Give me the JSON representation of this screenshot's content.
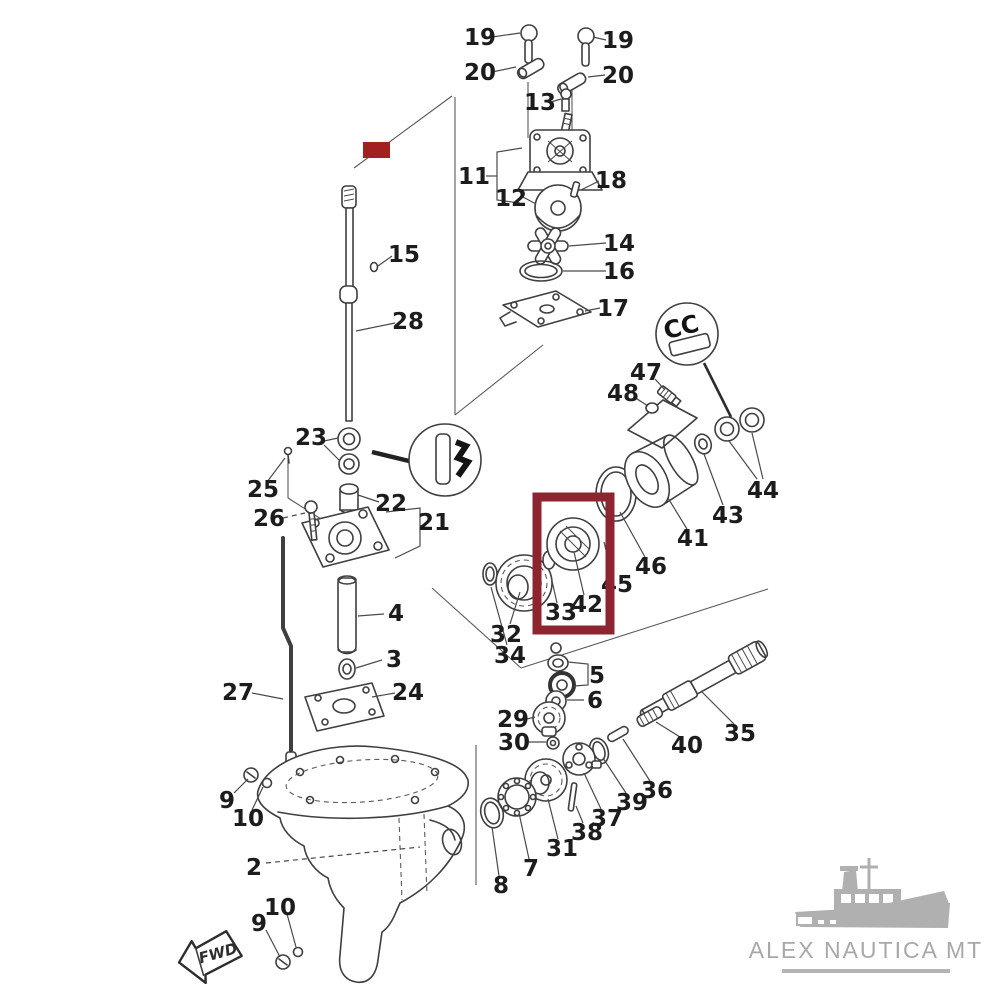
{
  "diagram": {
    "ink_color": "#3f3f3f",
    "label_color": "#1c1c1c",
    "background": "#ffffff"
  },
  "highlights": {
    "box": {
      "x": 537,
      "y": 497,
      "w": 73,
      "h": 133,
      "stroke": "#8e2430",
      "stroke_width": 9
    },
    "mark": {
      "x": 363,
      "y": 142,
      "w": 27,
      "h": 16,
      "fill": "#a32020"
    }
  },
  "callouts": {
    "right_glyph": "CC"
  },
  "fwd_flag": {
    "label": "FWD"
  },
  "watermark": {
    "text": "ALEX NAUTICA MT",
    "text_color": "#a8a8a8",
    "underline_color": "#b4b4b4",
    "boat_color": "#b0b0b0"
  },
  "labels": [
    {
      "t": "19",
      "x": 480,
      "y": 45
    },
    {
      "t": "19",
      "x": 618,
      "y": 48
    },
    {
      "t": "20",
      "x": 480,
      "y": 80
    },
    {
      "t": "20",
      "x": 618,
      "y": 83
    },
    {
      "t": "13",
      "x": 540,
      "y": 110
    },
    {
      "t": "11",
      "x": 474,
      "y": 184
    },
    {
      "t": "12",
      "x": 511,
      "y": 206
    },
    {
      "t": "18",
      "x": 611,
      "y": 188
    },
    {
      "t": "14",
      "x": 619,
      "y": 251
    },
    {
      "t": "16",
      "x": 619,
      "y": 279
    },
    {
      "t": "17",
      "x": 613,
      "y": 316
    },
    {
      "t": "15",
      "x": 404,
      "y": 262
    },
    {
      "t": "28",
      "x": 408,
      "y": 329
    },
    {
      "t": "23",
      "x": 311,
      "y": 445
    },
    {
      "t": "25",
      "x": 263,
      "y": 497
    },
    {
      "t": "26",
      "x": 269,
      "y": 526
    },
    {
      "t": "22",
      "x": 391,
      "y": 511
    },
    {
      "t": "21",
      "x": 434,
      "y": 530
    },
    {
      "t": "4",
      "x": 396,
      "y": 621
    },
    {
      "t": "3",
      "x": 394,
      "y": 667
    },
    {
      "t": "24",
      "x": 408,
      "y": 700
    },
    {
      "t": "27",
      "x": 238,
      "y": 700
    },
    {
      "t": "47",
      "x": 646,
      "y": 380
    },
    {
      "t": "48",
      "x": 623,
      "y": 401
    },
    {
      "t": "44",
      "x": 763,
      "y": 498
    },
    {
      "t": "43",
      "x": 728,
      "y": 523
    },
    {
      "t": "41",
      "x": 693,
      "y": 546
    },
    {
      "t": "46",
      "x": 651,
      "y": 574
    },
    {
      "t": "45",
      "x": 617,
      "y": 592
    },
    {
      "t": "42",
      "x": 587,
      "y": 612
    },
    {
      "t": "33",
      "x": 561,
      "y": 620
    },
    {
      "t": "32",
      "x": 506,
      "y": 642
    },
    {
      "t": "34",
      "x": 510,
      "y": 663
    },
    {
      "t": "5",
      "x": 597,
      "y": 683
    },
    {
      "t": "6",
      "x": 595,
      "y": 708
    },
    {
      "t": "29",
      "x": 513,
      "y": 727
    },
    {
      "t": "30",
      "x": 514,
      "y": 750
    },
    {
      "t": "35",
      "x": 740,
      "y": 741
    },
    {
      "t": "40",
      "x": 687,
      "y": 753
    },
    {
      "t": "36",
      "x": 657,
      "y": 798
    },
    {
      "t": "39",
      "x": 632,
      "y": 810
    },
    {
      "t": "37",
      "x": 607,
      "y": 826
    },
    {
      "t": "38",
      "x": 587,
      "y": 840
    },
    {
      "t": "31",
      "x": 562,
      "y": 856
    },
    {
      "t": "7",
      "x": 531,
      "y": 876
    },
    {
      "t": "8",
      "x": 501,
      "y": 893
    },
    {
      "t": "2",
      "x": 254,
      "y": 875
    },
    {
      "t": "9",
      "x": 227,
      "y": 808
    },
    {
      "t": "10",
      "x": 248,
      "y": 826
    },
    {
      "t": "10",
      "x": 280,
      "y": 915
    },
    {
      "t": "9",
      "x": 259,
      "y": 931
    }
  ],
  "leaders": [
    {
      "x1": 492,
      "y1": 37,
      "x2": 520,
      "y2": 33
    },
    {
      "x1": 606,
      "y1": 40,
      "x2": 593,
      "y2": 37
    },
    {
      "x1": 492,
      "y1": 72,
      "x2": 516,
      "y2": 67
    },
    {
      "x1": 605,
      "y1": 75,
      "x2": 588,
      "y2": 77
    },
    {
      "x1": 551,
      "y1": 102,
      "x2": 561,
      "y2": 99
    },
    {
      "x1": 523,
      "y1": 197,
      "x2": 536,
      "y2": 204
    },
    {
      "x1": 599,
      "y1": 181,
      "x2": 581,
      "y2": 190
    },
    {
      "x1": 606,
      "y1": 243,
      "x2": 569,
      "y2": 246
    },
    {
      "x1": 606,
      "y1": 271,
      "x2": 563,
      "y2": 271
    },
    {
      "x1": 600,
      "y1": 308,
      "x2": 585,
      "y2": 311
    },
    {
      "x1": 392,
      "y1": 256,
      "x2": 378,
      "y2": 266
    },
    {
      "x1": 395,
      "y1": 323,
      "x2": 356,
      "y2": 331
    },
    {
      "x1": 324,
      "y1": 441,
      "x2": 338,
      "y2": 438
    },
    {
      "x1": 324,
      "y1": 445,
      "x2": 340,
      "y2": 461
    },
    {
      "x1": 267,
      "y1": 482,
      "x2": 285,
      "y2": 458
    },
    {
      "x1": 283,
      "y1": 518,
      "x2": 305,
      "y2": 513,
      "d": 1
    },
    {
      "x1": 379,
      "y1": 502,
      "x2": 358,
      "y2": 495
    },
    {
      "x1": 384,
      "y1": 614,
      "x2": 358,
      "y2": 616
    },
    {
      "x1": 382,
      "y1": 660,
      "x2": 356,
      "y2": 668
    },
    {
      "x1": 395,
      "y1": 693,
      "x2": 372,
      "y2": 697
    },
    {
      "x1": 252,
      "y1": 693,
      "x2": 283,
      "y2": 699
    },
    {
      "x1": 655,
      "y1": 379,
      "x2": 665,
      "y2": 390
    },
    {
      "x1": 634,
      "y1": 397,
      "x2": 648,
      "y2": 406
    },
    {
      "x1": 757,
      "y1": 479,
      "x2": 729,
      "y2": 441
    },
    {
      "x1": 763,
      "y1": 479,
      "x2": 752,
      "y2": 433
    },
    {
      "x1": 723,
      "y1": 505,
      "x2": 704,
      "y2": 454
    },
    {
      "x1": 687,
      "y1": 529,
      "x2": 668,
      "y2": 498
    },
    {
      "x1": 645,
      "y1": 557,
      "x2": 620,
      "y2": 512
    },
    {
      "x1": 612,
      "y1": 575,
      "x2": 604,
      "y2": 542
    },
    {
      "x1": 584,
      "y1": 595,
      "x2": 574,
      "y2": 552
    },
    {
      "x1": 557,
      "y1": 603,
      "x2": 550,
      "y2": 572
    },
    {
      "x1": 510,
      "y1": 624,
      "x2": 520,
      "y2": 592
    },
    {
      "x1": 507,
      "y1": 645,
      "x2": 491,
      "y2": 587
    },
    {
      "x1": 584,
      "y1": 700,
      "x2": 567,
      "y2": 700
    },
    {
      "x1": 527,
      "y1": 719,
      "x2": 535,
      "y2": 717
    },
    {
      "x1": 528,
      "y1": 742,
      "x2": 546,
      "y2": 742
    },
    {
      "x1": 734,
      "y1": 724,
      "x2": 701,
      "y2": 691
    },
    {
      "x1": 680,
      "y1": 737,
      "x2": 656,
      "y2": 722
    },
    {
      "x1": 650,
      "y1": 781,
      "x2": 623,
      "y2": 739
    },
    {
      "x1": 626,
      "y1": 793,
      "x2": 603,
      "y2": 758
    },
    {
      "x1": 601,
      "y1": 809,
      "x2": 584,
      "y2": 773
    },
    {
      "x1": 583,
      "y1": 823,
      "x2": 576,
      "y2": 806
    },
    {
      "x1": 558,
      "y1": 839,
      "x2": 548,
      "y2": 799
    },
    {
      "x1": 529,
      "y1": 859,
      "x2": 519,
      "y2": 813
    },
    {
      "x1": 499,
      "y1": 876,
      "x2": 492,
      "y2": 827
    },
    {
      "x1": 266,
      "y1": 863,
      "x2": 420,
      "y2": 847,
      "d": 1
    },
    {
      "x1": 234,
      "y1": 793,
      "x2": 248,
      "y2": 779
    },
    {
      "x1": 252,
      "y1": 810,
      "x2": 263,
      "y2": 787
    },
    {
      "x1": 287,
      "y1": 914,
      "x2": 296,
      "y2": 947
    },
    {
      "x1": 266,
      "y1": 930,
      "x2": 280,
      "y2": 957
    }
  ]
}
